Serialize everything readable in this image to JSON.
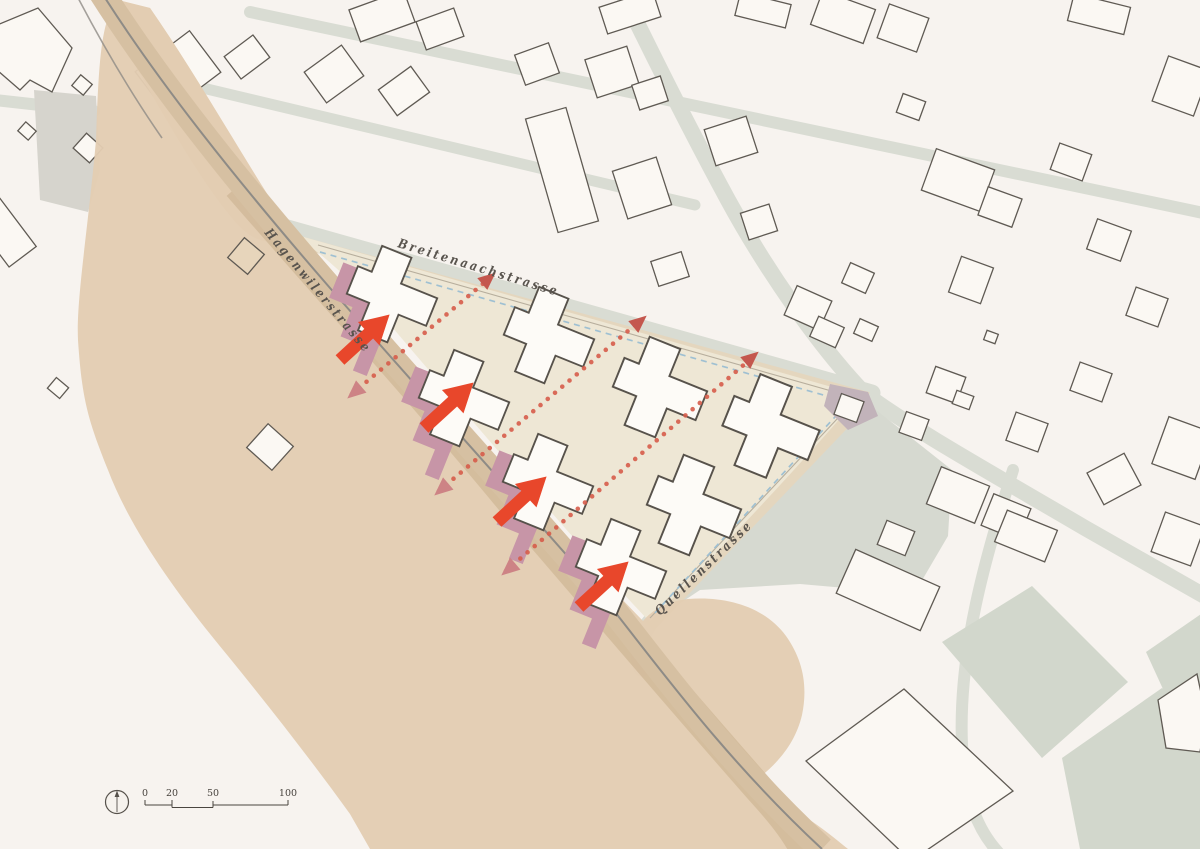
{
  "streets": [
    {
      "name": "Hagenwilerstrasse"
    },
    {
      "name": "Breitenaachstrasse"
    },
    {
      "name": "Quellenstrasse"
    }
  ],
  "scale_bar": {
    "labels": [
      "0",
      "20",
      "50",
      "100"
    ]
  },
  "icons": {
    "compass": "north-arrow"
  },
  "colors": {
    "background": "#f7f3ef",
    "road_gray": "#d9dcd3",
    "parcel_green_gray": "#d2d7cc",
    "landscape_tan": "#e3cdb2",
    "road_band_tan": "#d6c0a2",
    "site_cream": "#eee7d5",
    "boundary_blue": "#9fc0d2",
    "building_outline": "#57524b",
    "highlight_pink": "#c795a7",
    "arrow_red": "#e8472b",
    "dotted_red": "#d65c4a",
    "triangle_pink": "#cd8385",
    "label_gray": "#59544e"
  }
}
